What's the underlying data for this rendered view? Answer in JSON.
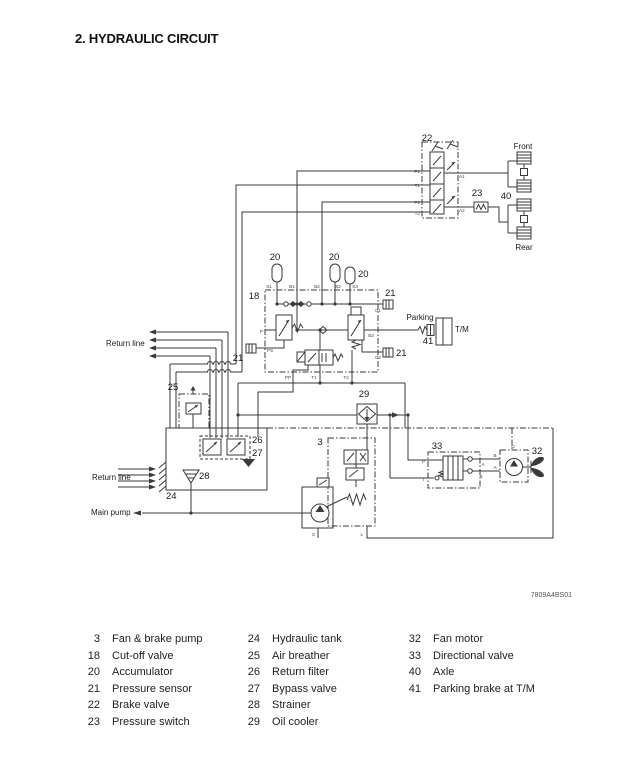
{
  "page": {
    "title": "2. HYDRAULIC CIRCUIT",
    "figure_code": "7809A4BS01"
  },
  "diagram": {
    "labels": {
      "n22": "22",
      "n23": "23",
      "n40": "40",
      "front": "Front",
      "rear": "Rear",
      "n20a": "20",
      "n20b": "20",
      "n20c": "20",
      "n18": "18",
      "n21_g1": "21",
      "n21_ps": "21",
      "n21_g2": "21",
      "parking": "Parking",
      "tm": "T/M",
      "n41": "41",
      "return_line_top": "Return line",
      "return_line_bottom": "Return line",
      "n25": "25",
      "n29": "29",
      "n3": "3",
      "n26": "26",
      "n27": "27",
      "n28": "28",
      "n24": "24",
      "main_pump": "Main pump",
      "n33": "33",
      "n32": "32"
    },
    "ports": {
      "p1": "P1",
      "t1": "T1",
      "p2": "P2",
      "t2": "T2",
      "a1": "A1",
      "a2": "A2",
      "s1": "S1",
      "b1": "B1",
      "b2": "B2",
      "s2": "S2",
      "s3": "S3",
      "g1": "G1",
      "g2": "G2",
      "ps": "PS",
      "p": "P",
      "b3": "B3",
      "pp": "PP",
      "t1_bottom": "T1",
      "t2_bottom": "T2",
      "p_dir": "P",
      "t_dir": "T",
      "a_dir": "A",
      "b_dir": "B",
      "b_motor": "B",
      "a_motor": "A",
      "d": "D",
      "s_pump": "S",
      "l_pump": "L"
    }
  },
  "legend": {
    "columns": [
      [
        {
          "num": "3",
          "name": "Fan & brake pump"
        },
        {
          "num": "18",
          "name": "Cut-off valve"
        },
        {
          "num": "20",
          "name": "Accumulator"
        },
        {
          "num": "21",
          "name": "Pressure sensor"
        },
        {
          "num": "22",
          "name": "Brake valve"
        },
        {
          "num": "23",
          "name": "Pressure switch"
        }
      ],
      [
        {
          "num": "24",
          "name": "Hydraulic tank"
        },
        {
          "num": "25",
          "name": "Air breather"
        },
        {
          "num": "26",
          "name": "Return filter"
        },
        {
          "num": "27",
          "name": "Bypass valve"
        },
        {
          "num": "28",
          "name": "Strainer"
        },
        {
          "num": "29",
          "name": "Oil cooler"
        }
      ],
      [
        {
          "num": "32",
          "name": "Fan motor"
        },
        {
          "num": "33",
          "name": "Directional valve"
        },
        {
          "num": "40",
          "name": "Axle"
        },
        {
          "num": "41",
          "name": "Parking brake at T/M"
        }
      ]
    ]
  }
}
